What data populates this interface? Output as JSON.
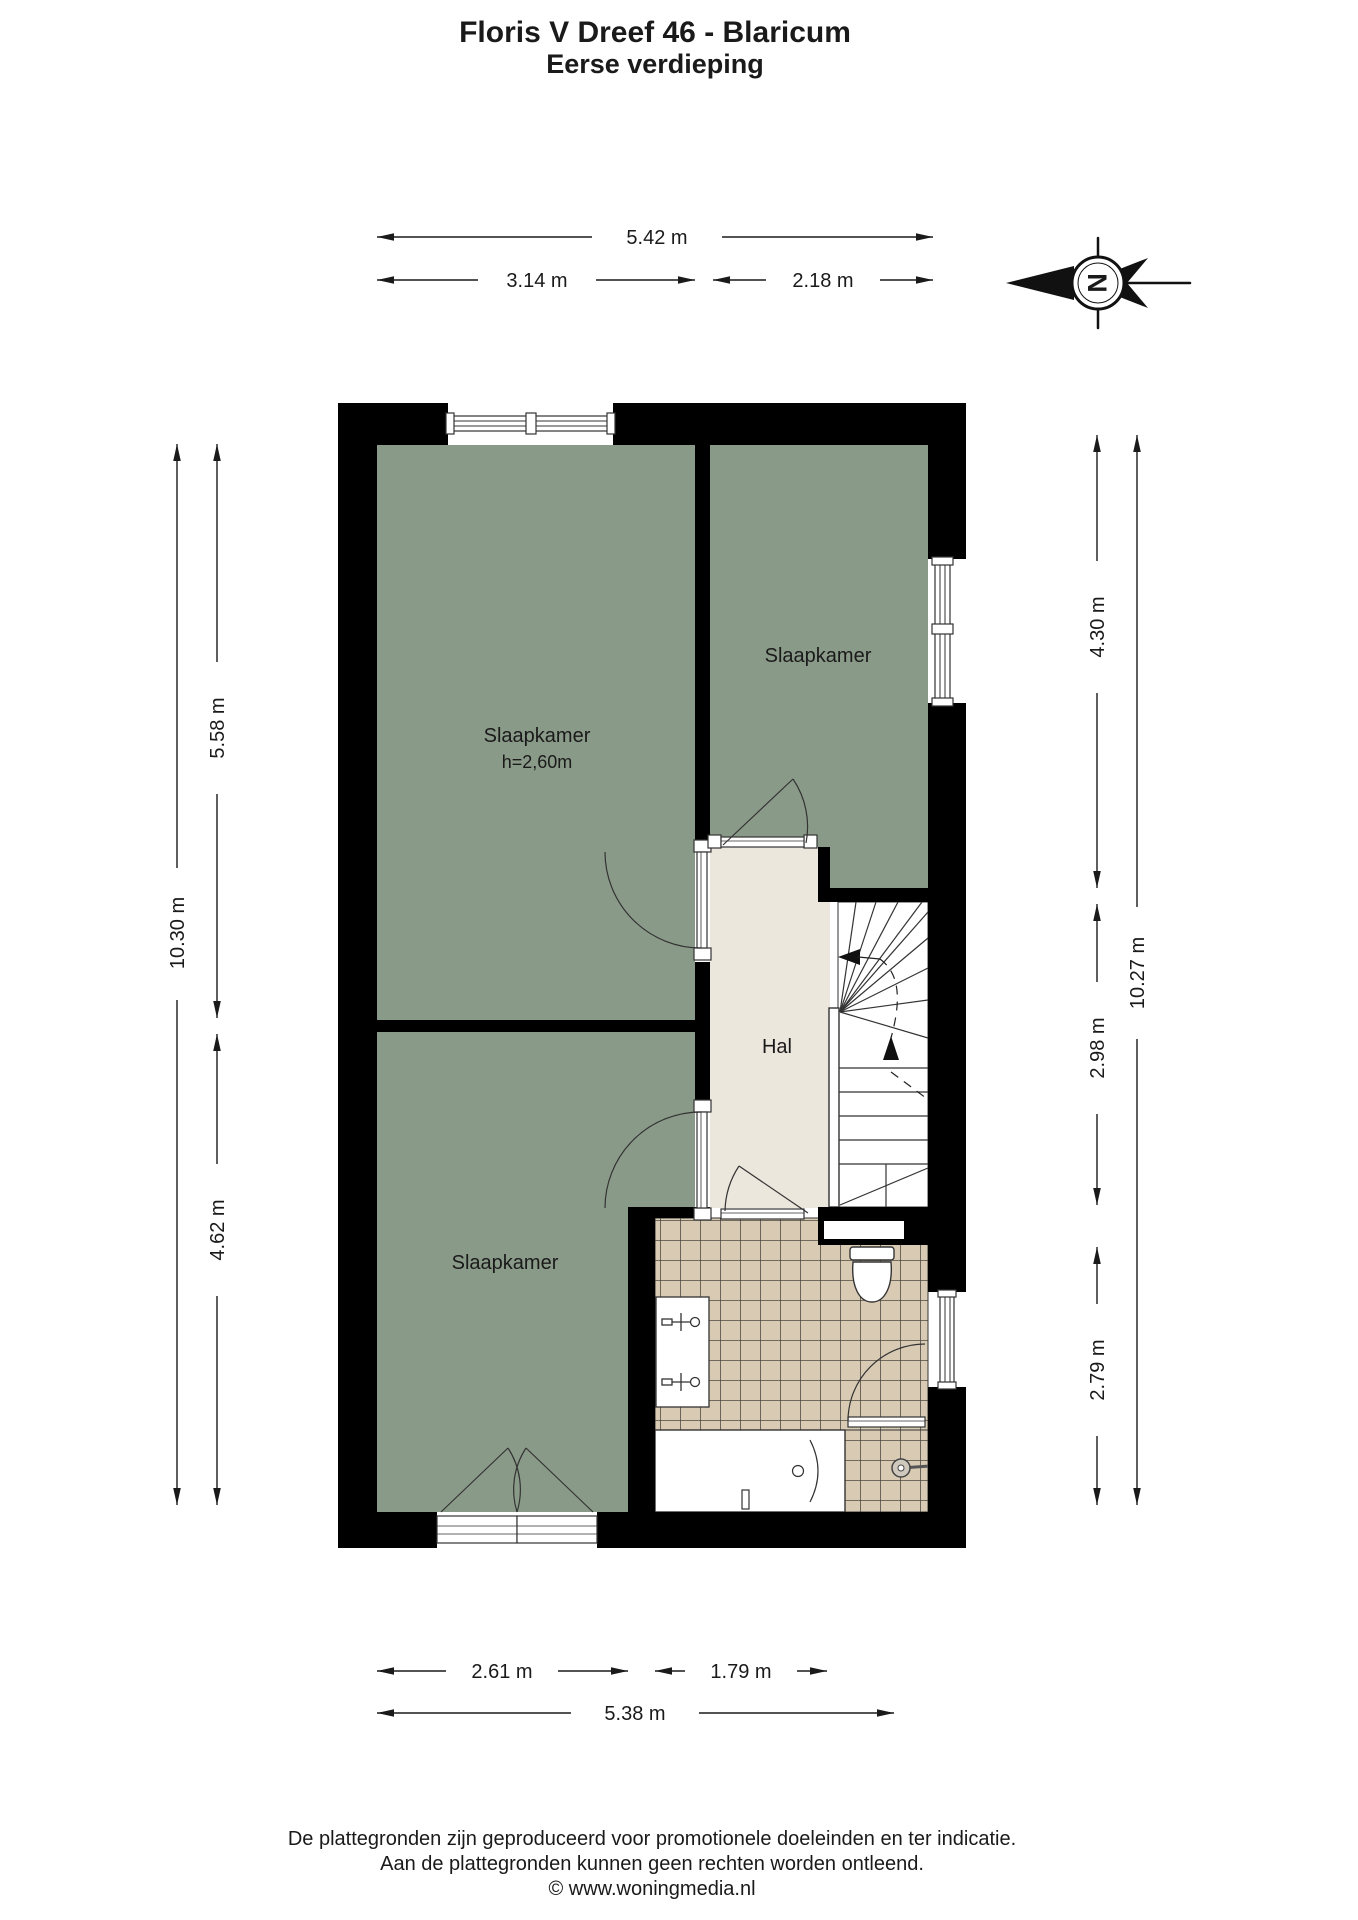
{
  "title": {
    "line1": "Floris V Dreef 46 - Blaricum",
    "line2": "Eerse verdieping"
  },
  "compass": {
    "letter": "N"
  },
  "dimensions": {
    "top_total": "5.42 m",
    "top_left": "3.14 m",
    "top_right": "2.18 m",
    "left_total": "10.30 m",
    "left_upper": "5.58 m",
    "left_lower": "4.62 m",
    "right_total": "10.27 m",
    "right_upper": "4.30 m",
    "right_middle": "2.98 m",
    "right_lower": "2.79 m",
    "bottom_left": "2.61 m",
    "bottom_right": "1.79 m",
    "bottom_total": "5.38 m"
  },
  "rooms": {
    "bedroom_top_left": {
      "label": "Slaapkamer",
      "ceiling_height": "h=2,60m"
    },
    "bedroom_top_right": {
      "label": "Slaapkamer"
    },
    "bedroom_bottom_left": {
      "label": "Slaapkamer"
    },
    "hall": {
      "label": "Hal"
    }
  },
  "footer": {
    "line1": "De plattegronden zijn geproduceerd voor promotionele doeleinden en ter indicatie.",
    "line2": "Aan de plattegronden kunnen geen rechten worden ontleend.",
    "line3": "© www.woningmedia.nl"
  },
  "colors": {
    "wall": "#000000",
    "room_green": "#8a9a88",
    "hall_floor": "#ece7dd",
    "tile_fill": "#d9cbb3",
    "tile_grout": "#4e4a43",
    "background": "#ffffff"
  }
}
